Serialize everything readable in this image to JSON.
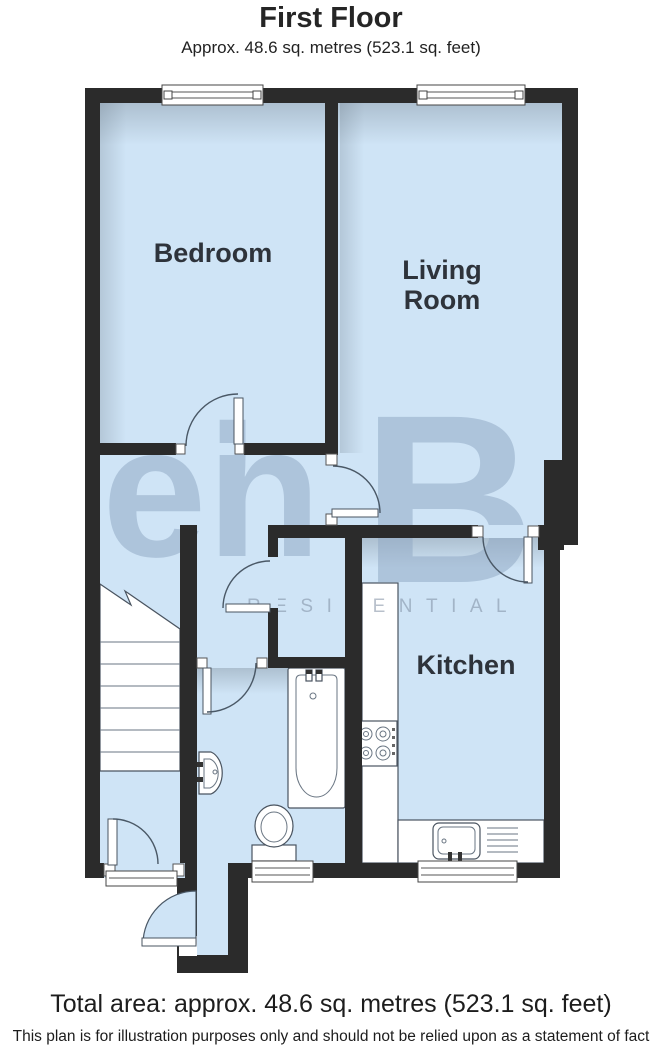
{
  "header": {
    "title": "First Floor",
    "subtitle": "Approx. 48.6 sq. metres (523.1 sq. feet)"
  },
  "rooms": {
    "bedroom": "Bedroom",
    "living_line1": "Living",
    "living_line2": "Room",
    "kitchen": "Kitchen"
  },
  "watermark": {
    "logo_eh": "eh",
    "logo_b": "B",
    "tagline": "RESIDENTIAL"
  },
  "footer": {
    "total_area": "Total area: approx. 48.6 sq. metres (523.1 sq. feet)",
    "disclaimer": "This plan is for illustration purposes only and should not be relied upon as a statement of fact"
  },
  "colors": {
    "wall": "#2b2b2b",
    "floor": "#cfe4f6",
    "line": "#4a5866",
    "label": "#2e333b"
  }
}
